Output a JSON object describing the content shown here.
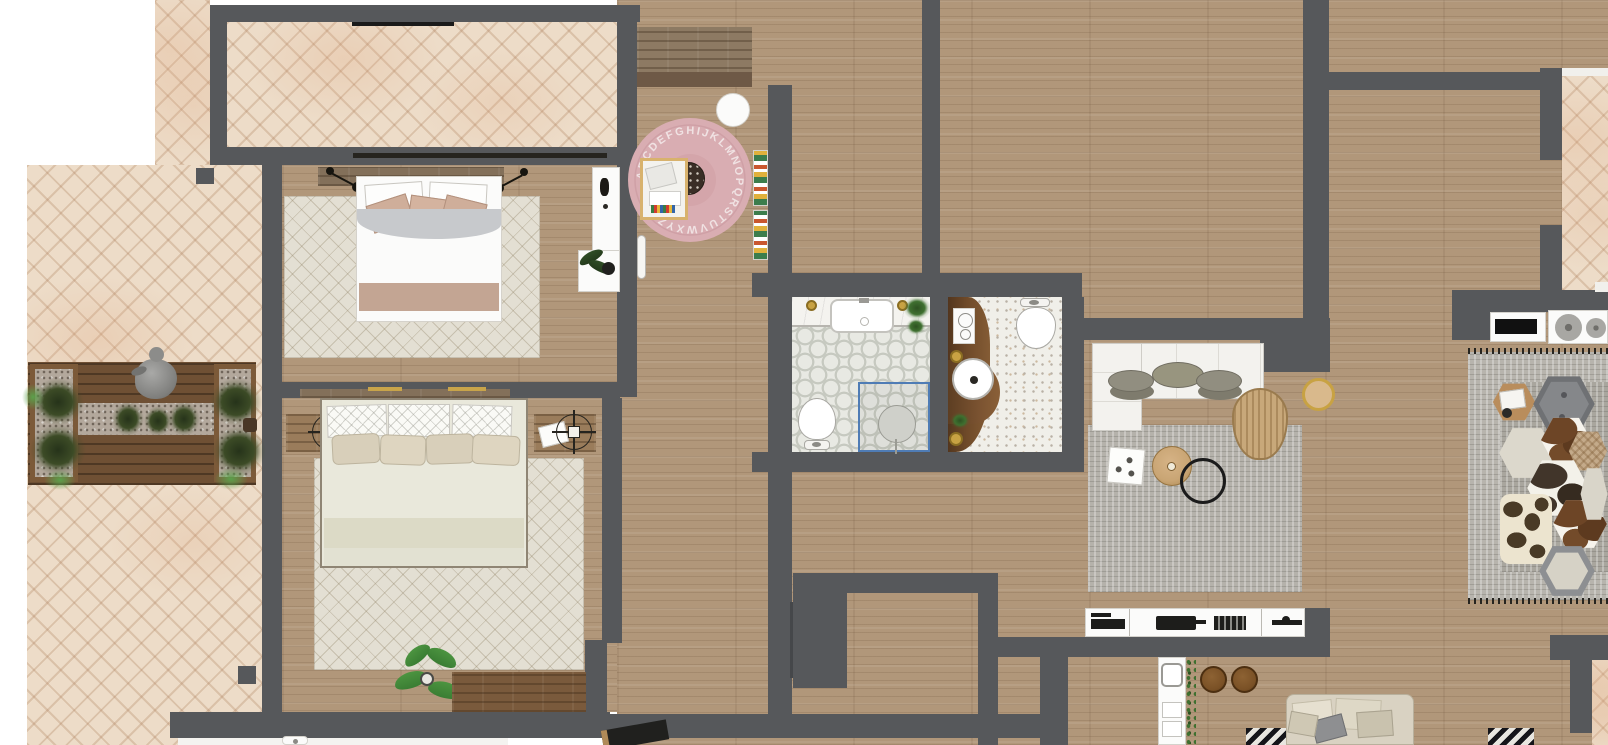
{
  "canvas": {
    "width": 1608,
    "height": 745,
    "description": "top-down interior floor plan render"
  },
  "palette": {
    "wall": "#56585b",
    "wood": "#b1977a",
    "herringbone": "#eddcc8",
    "deck": "#6f5034",
    "tile_bath": "#e8e9e3",
    "tile_accent": "#c6c9c0",
    "terrazzo": "#f0efe9",
    "rug_pink": "#d9adb2",
    "rug_gray": "#b5b2ab",
    "rug_cream": "#e3dfd3",
    "gold": "#c8a243",
    "shower_glass": "#4f7cb5",
    "plant_dark": "#3c4b26",
    "plant_green": "#4c9440"
  },
  "kid_room": {
    "rug_letters": "ABCDEFGHIJKLMNOPQRSTUVWXYZ"
  }
}
